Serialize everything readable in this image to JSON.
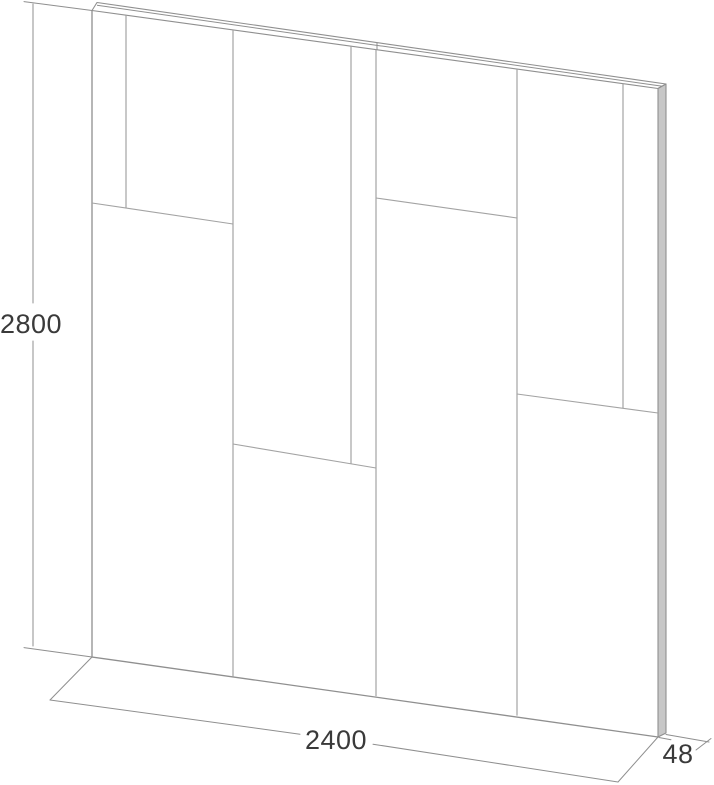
{
  "drawing": {
    "kind": "wall-panel-technical-drawing",
    "dimensions": {
      "height": "2800",
      "width": "2400",
      "depth": "48"
    },
    "colors": {
      "outline": "#8f8f8f",
      "seam": "#a3a3a3",
      "dim_line": "#8f8f8f",
      "label_text": "#3a3a3a",
      "edge_fill": "#c7c7c7",
      "background": "#ffffff"
    }
  }
}
